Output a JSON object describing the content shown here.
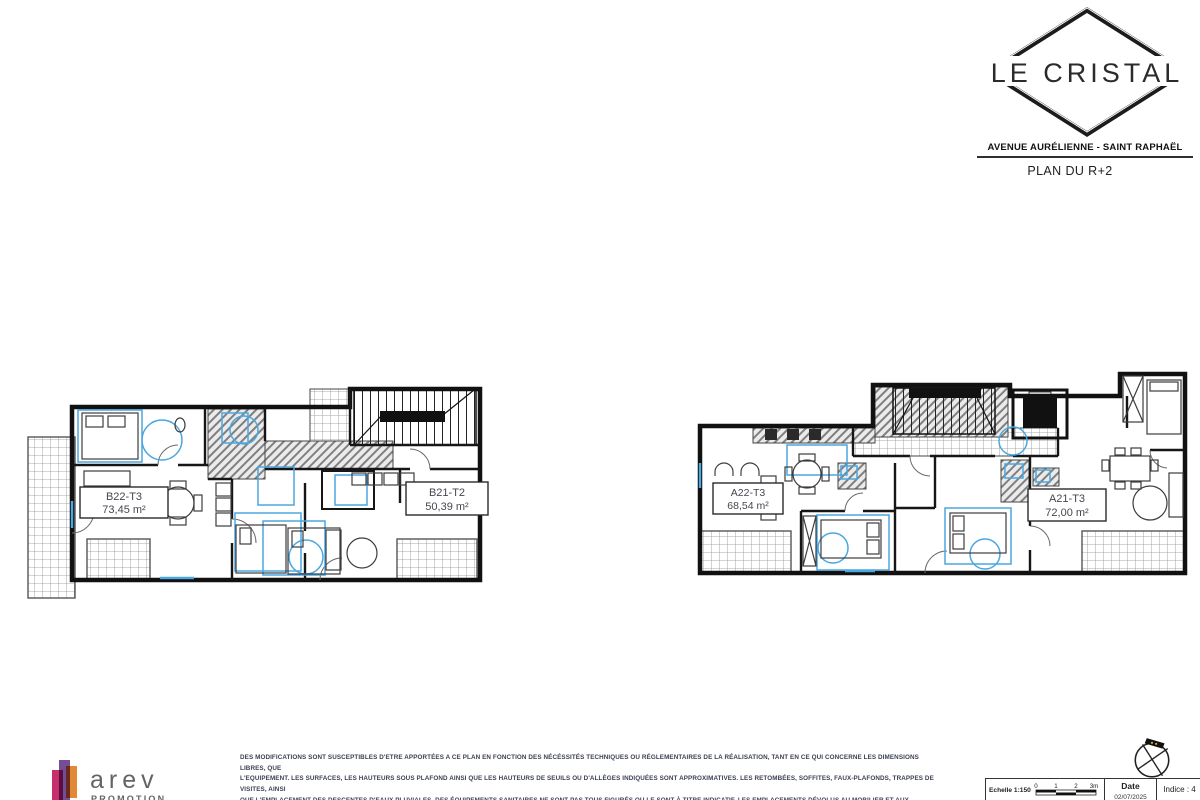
{
  "header": {
    "logo_title": "LE CRISTAL",
    "address": "AVENUE AURÉLIENNE - SAINT RAPHAËL",
    "plan_title": "PLAN DU R+2"
  },
  "plans": {
    "left": {
      "units": [
        {
          "id": "B22-T3",
          "area": "73,45 m²"
        },
        {
          "id": "B21-T2",
          "area": "50,39 m²"
        }
      ]
    },
    "right": {
      "units": [
        {
          "id": "A22-T3",
          "area": "68,54 m²"
        },
        {
          "id": "A21-T3",
          "area": "72,00 m²"
        }
      ]
    }
  },
  "footer": {
    "publisher": {
      "name": "arev",
      "subtitle": "PROMOTION"
    },
    "disclaimer_lines": [
      "DES MODIFICATIONS SONT SUSCEPTIBLES D'ETRE APPORTÉES A CE PLAN EN FONCTION DES NÉCÉSSITÉS TECHNIQUES OU RÉGLEMENTAIRES DE LA RÉALISATION, TANT EN CE QUI CONCERNE LES DIMENSIONS LIBRES, QUE",
      "L'EQUIPEMENT. LES SURFACES, LES HAUTEURS SOUS PLAFOND AINSI QUE LES HAUTEURS DE SEUILS OU D'ALLÈGES INDIQUÉES SONT APPROXIMATIVES. LES RETOMBÉES, SOFFITES, FAUX-PLAFONDS, TRAPPES DE VISITES, AINSI",
      "QUE L'EMPLACEMENT DES DESCENTES D'EAUX PLUVIALES, DES ÉQUIPEMENTS SANITAIRES NE SONT PAS TOUS FIGURÉS OU LE SONT À TITRE INDICATIF. LES EMPLACEMENTS DÉVOLUS AU MOBILIER ET AUX ÉQUIPEMENTS",
      "MÉNAGERS ET À CEUX LIÉS AU LAVAGE DU LINGE SONT REPRÉSENTÉS EN CORRESPONDANCE AVEC LES DIFFÉRENTS RACCORDEMENTS NÉCESSAIRES EN ÉLECTRICITÉ ET EN EAU : AUCUN DE CES ÉLÉMENTS N'EST FOURNI.",
      ""
    ],
    "titleblock": {
      "scale_label": "Echelle 1:150",
      "scale_ticks": [
        "0",
        "1",
        "2",
        "3m"
      ],
      "date_label": "Date",
      "date_value": "02/07/2025",
      "indice": "Indice : 4"
    }
  },
  "colors": {
    "accent_blue": "#4aa7e0",
    "wall_black": "#111111",
    "logo_red": "#c0175c",
    "logo_purple": "#5c2d82",
    "logo_orange": "#e07c1f"
  }
}
